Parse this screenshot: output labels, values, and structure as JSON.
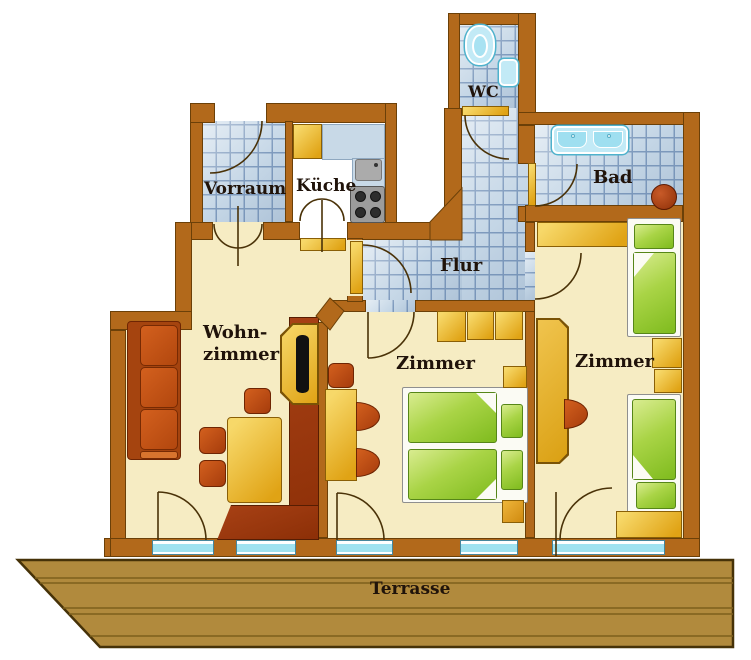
{
  "labels": {
    "vorraum": "Vorraum",
    "kueche": "Küche",
    "wc": "WC",
    "bad": "Bad",
    "flur": "Flur",
    "wohnzimmer_line1": "Wohn-",
    "wohnzimmer_line2": "zimmer",
    "zimmer_mitte": "Zimmer",
    "zimmer_rechts": "Zimmer",
    "terrasse": "Terrasse"
  },
  "colors": {
    "wall_brown": "#b2691b",
    "floor_cream": "#f6ecc3",
    "tile_blue": "#ccdcea",
    "furniture_gold": "#e8b126",
    "furniture_orange": "#c44f13",
    "media_dark_red": "#9c3a10",
    "bed_green": "#9ccc33",
    "fixture_cyan": "#c2eaf6",
    "window_cyan": "#9fe2f0",
    "terrace_wood": "#b18a3d",
    "label_text": "#20130a"
  }
}
